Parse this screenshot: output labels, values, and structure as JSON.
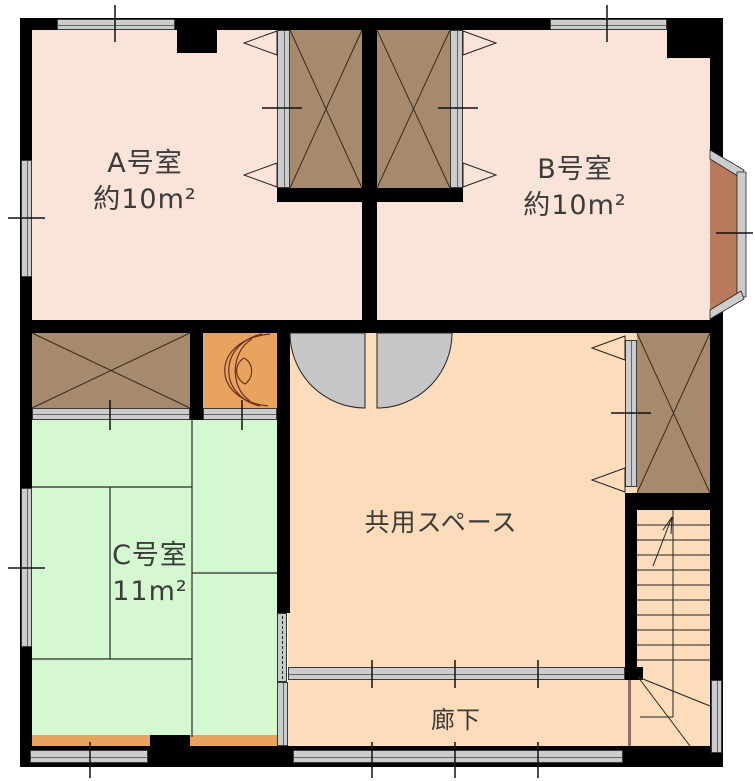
{
  "plan": {
    "rooms": {
      "room_a": {
        "name": "A号室",
        "area": "約10m²"
      },
      "room_b": {
        "name": "B号室",
        "area": "約10m²"
      },
      "room_c": {
        "name": "C号室",
        "area": "11m²"
      },
      "shared": {
        "name": "共用スペース"
      },
      "corridor": {
        "name": "廊下"
      }
    },
    "colors": {
      "wall": "#000000",
      "room_ab_floor": "#fbe3d9",
      "common_floor": "#fcdcba",
      "tatami_floor": "#d4f8d0",
      "closet": "#a58a6e",
      "wood_grain": "#e8a35e",
      "bay_sill": "#b9795c",
      "window": "#cbcccd",
      "door_leaf": "#c5c6c8"
    }
  }
}
